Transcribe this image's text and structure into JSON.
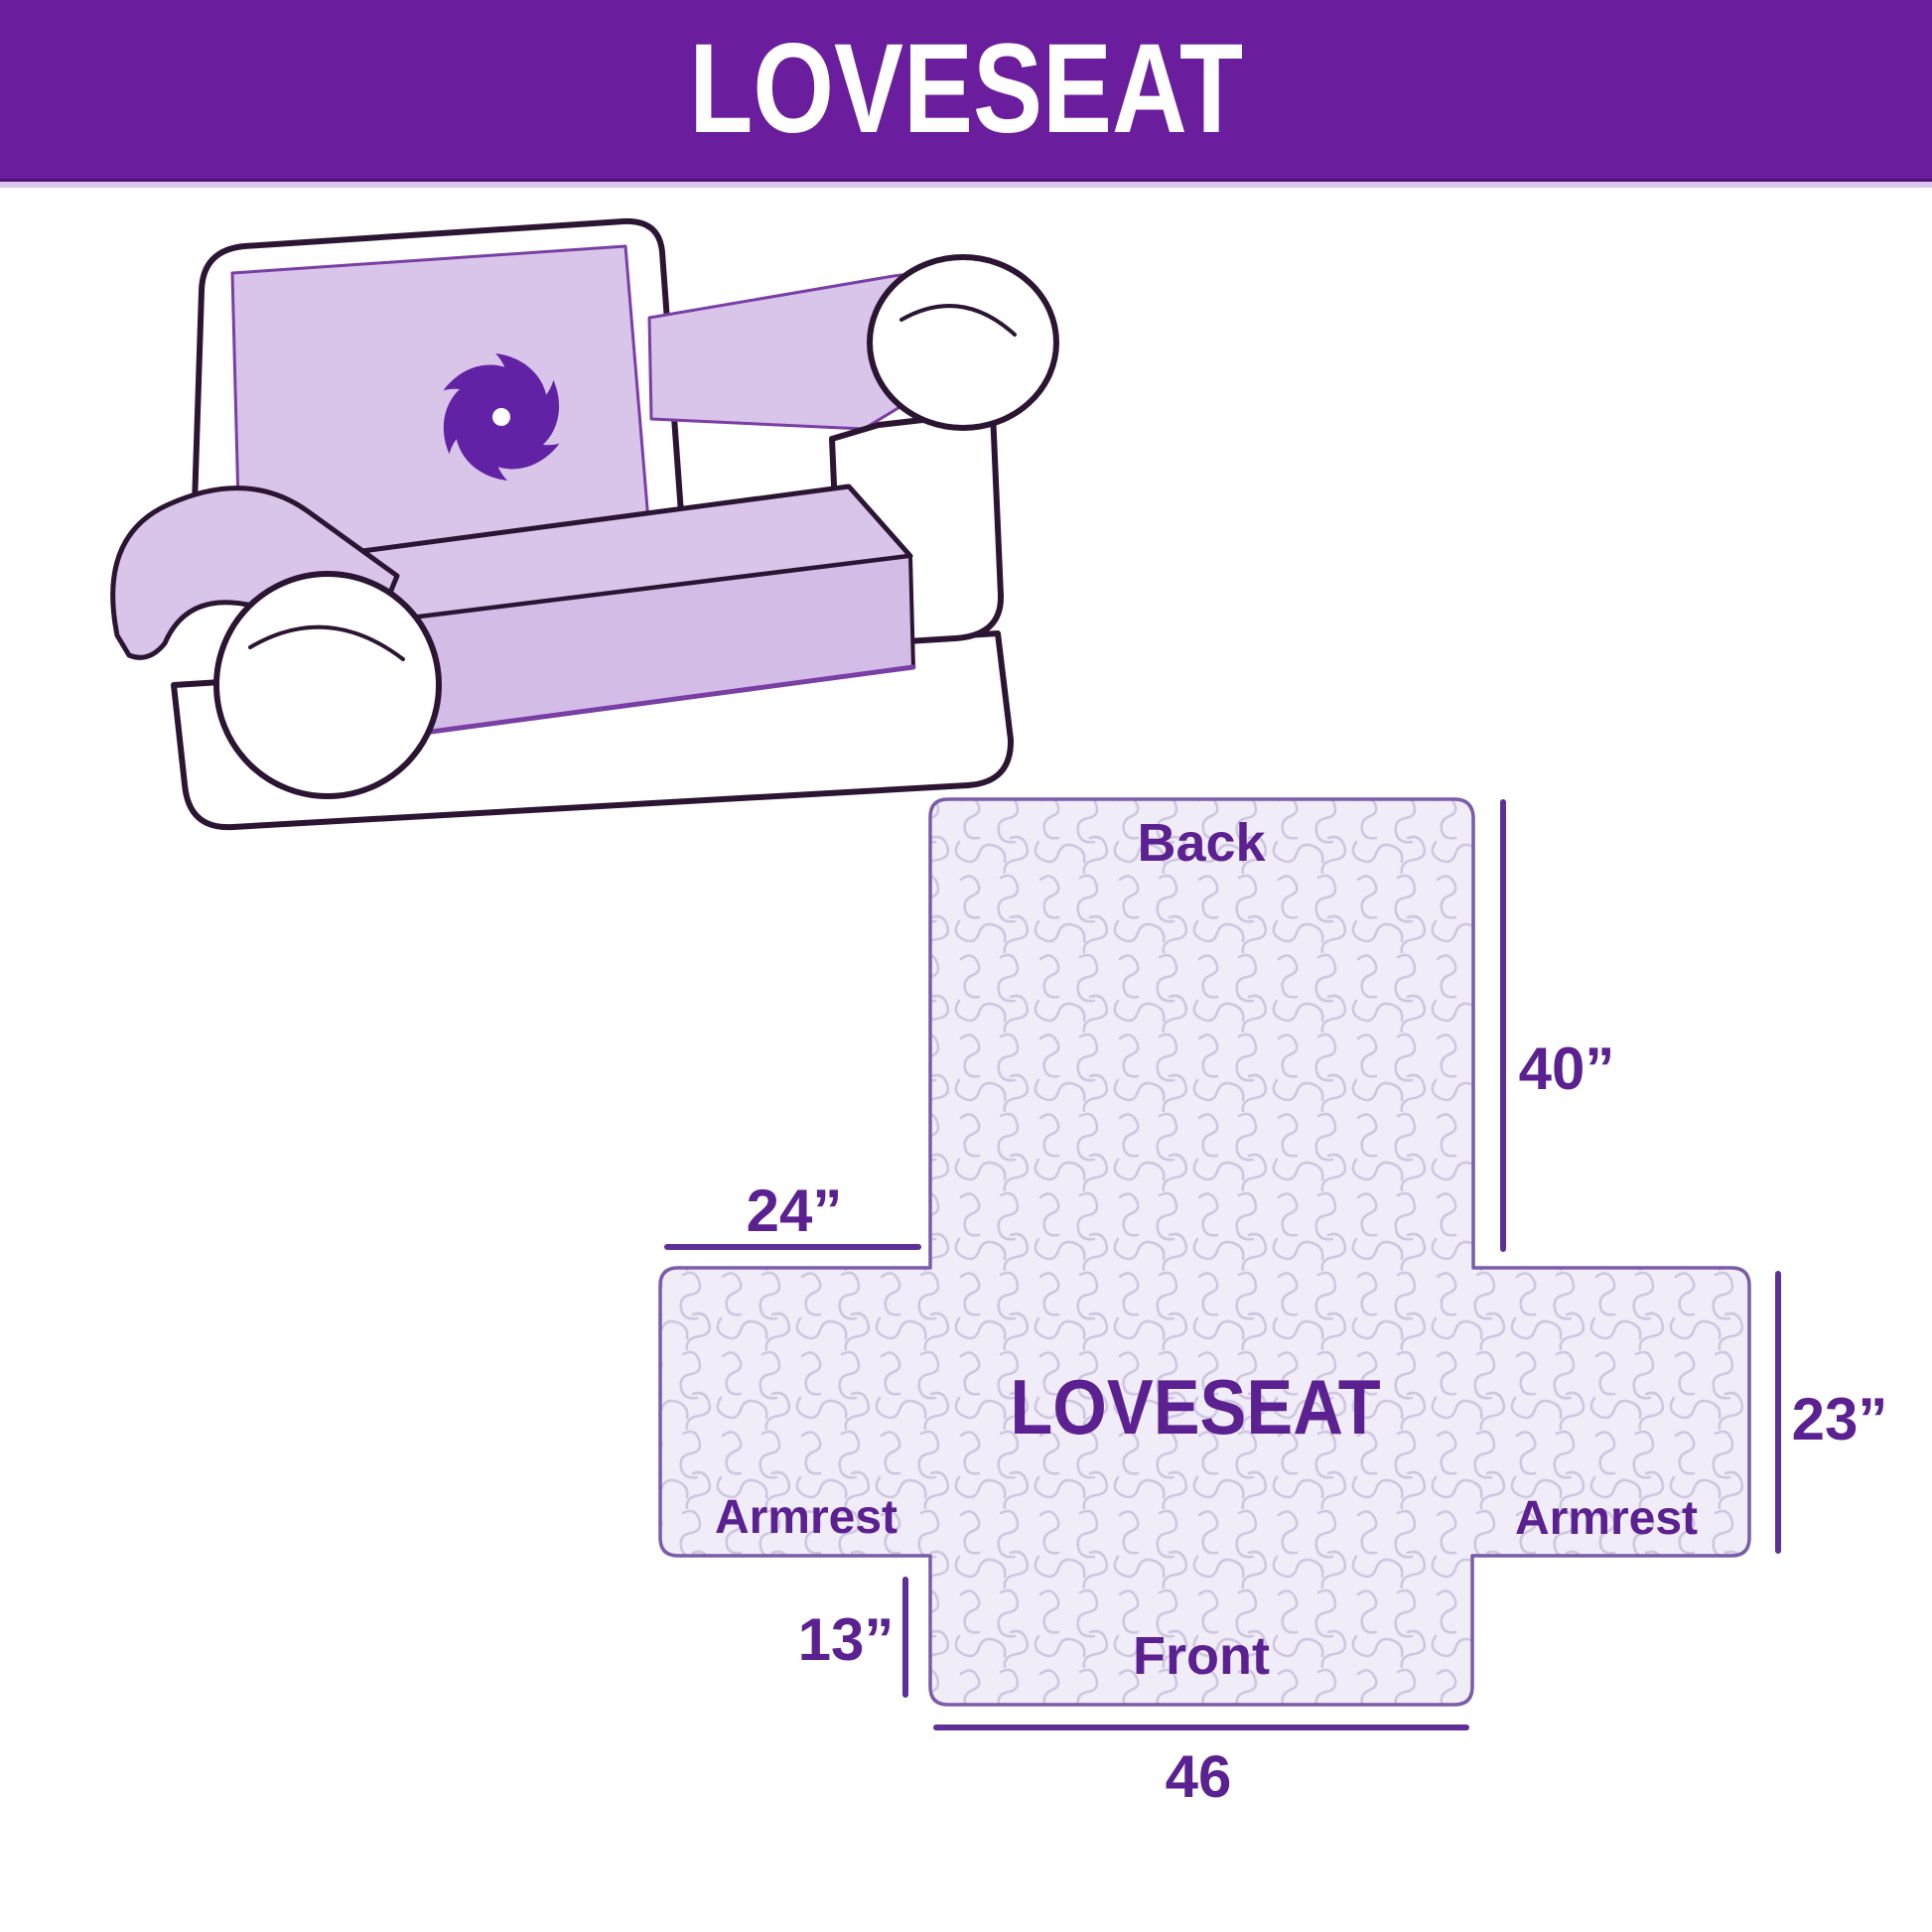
{
  "header": {
    "title": "LOVESEAT"
  },
  "illustration": {
    "description": "loveseat sofa with light-purple quilted slipcover",
    "logo_icon": "pinwheel-icon"
  },
  "diagram": {
    "center_label": "LOVESEAT",
    "back_label": "Back",
    "front_label": "Front",
    "armrest_left_label": "Armrest",
    "armrest_right_label": "Armrest",
    "dim_back_height": "40”",
    "dim_shoulder_width": "24”",
    "dim_side_height": "23”",
    "dim_front_drop": "13”",
    "dim_front_width": "46"
  },
  "colors": {
    "header_bg": "#6a1d9d",
    "header_text": "#ffffff",
    "label_purple": "#5b2191",
    "dimension_line": "#5e2f96",
    "panel_fill": "#f0ecf8",
    "quilt_line": "#cfc7e0",
    "panel_border": "#7a5ca8",
    "cover_lavender": "#d9c4ea",
    "cover_lavender_shade": "#d3bce6",
    "sofa_outline": "#2c1533",
    "pinwheel_purple": "#6222a5"
  }
}
